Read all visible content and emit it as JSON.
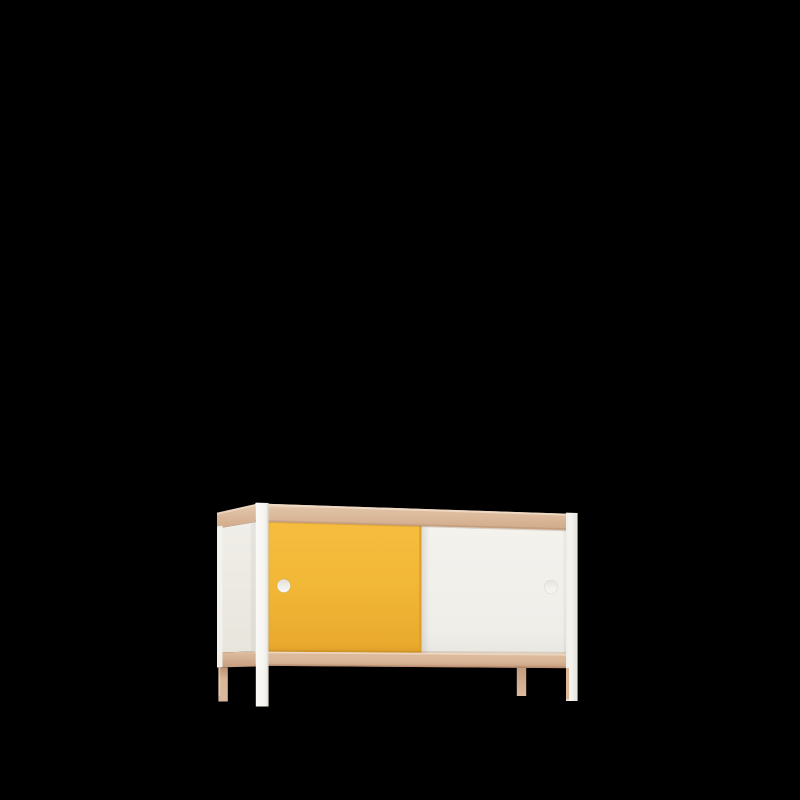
{
  "scene": {
    "description": "3D product render of a mid-century style sideboard (credenza) with two sliding doors — one yellow, one white — a pale wood frame with top and bottom rails, white corner legs in front, wood legs at rear, circular finger-hole handles, on a solid black background",
    "background_color": "#000000"
  },
  "sideboard": {
    "doors": [
      {
        "name": "left sliding door",
        "color_name": "yellow",
        "handle": "circular finger hole"
      },
      {
        "name": "right sliding door",
        "color_name": "white",
        "handle": "circular finger hole"
      }
    ],
    "frame": "pale beech wood rails, white front legs, wood rear legs",
    "visible_faces": [
      "front",
      "left side",
      "top edge"
    ]
  },
  "materials": {
    "yellow_door": {
      "light": "#F6BD3F",
      "base": "#F2B736",
      "dark": "#E9AA2E",
      "edge": "#DE9E28"
    },
    "white_door": {
      "light": "#F3F2ED",
      "base": "#F0EEE9",
      "dark": "#E9E7E0"
    },
    "wood": {
      "highlight": "#EFDAC4",
      "light": "#E0C1A4",
      "base": "#D9B697",
      "dark": "#CFA98A",
      "edge_dark": "#B98F6F",
      "bottom_light": "#DDBB9D",
      "bottom_dark": "#C39A7C",
      "bottom_edge": "#B08466",
      "side_light": "#E4C9AF",
      "side_dark": "#D2A98A",
      "side_bottom_light": "#E0BFA1",
      "side_bottom_dark": "#C69C7E",
      "leg_shadow": "#C09375",
      "leg_light": "#D9B99E",
      "leg_right_shadow": "#C59C7E",
      "leg_right_light": "#DCBB9F",
      "front_leg_sliver": "#DCB392",
      "leg_edge_light": "#EFDCCB"
    },
    "frame_white": {
      "light": "#FAF9F6",
      "base": "#F6F5F1",
      "shade": "#EFEDE8",
      "dark": "#E5E2DB",
      "rear_strip": "#F2F1EC"
    },
    "side_panel": {
      "light": "#F0EEE8",
      "dark": "#E8E5DD"
    },
    "handle": {
      "shadow": "#E4E0D8",
      "mid": "#F0EEE8",
      "light": "#F9F8F5",
      "white_shadow": "#E8E5DE",
      "white_mid": "#F2F1EC",
      "white_light": "#F7F6F3"
    }
  }
}
